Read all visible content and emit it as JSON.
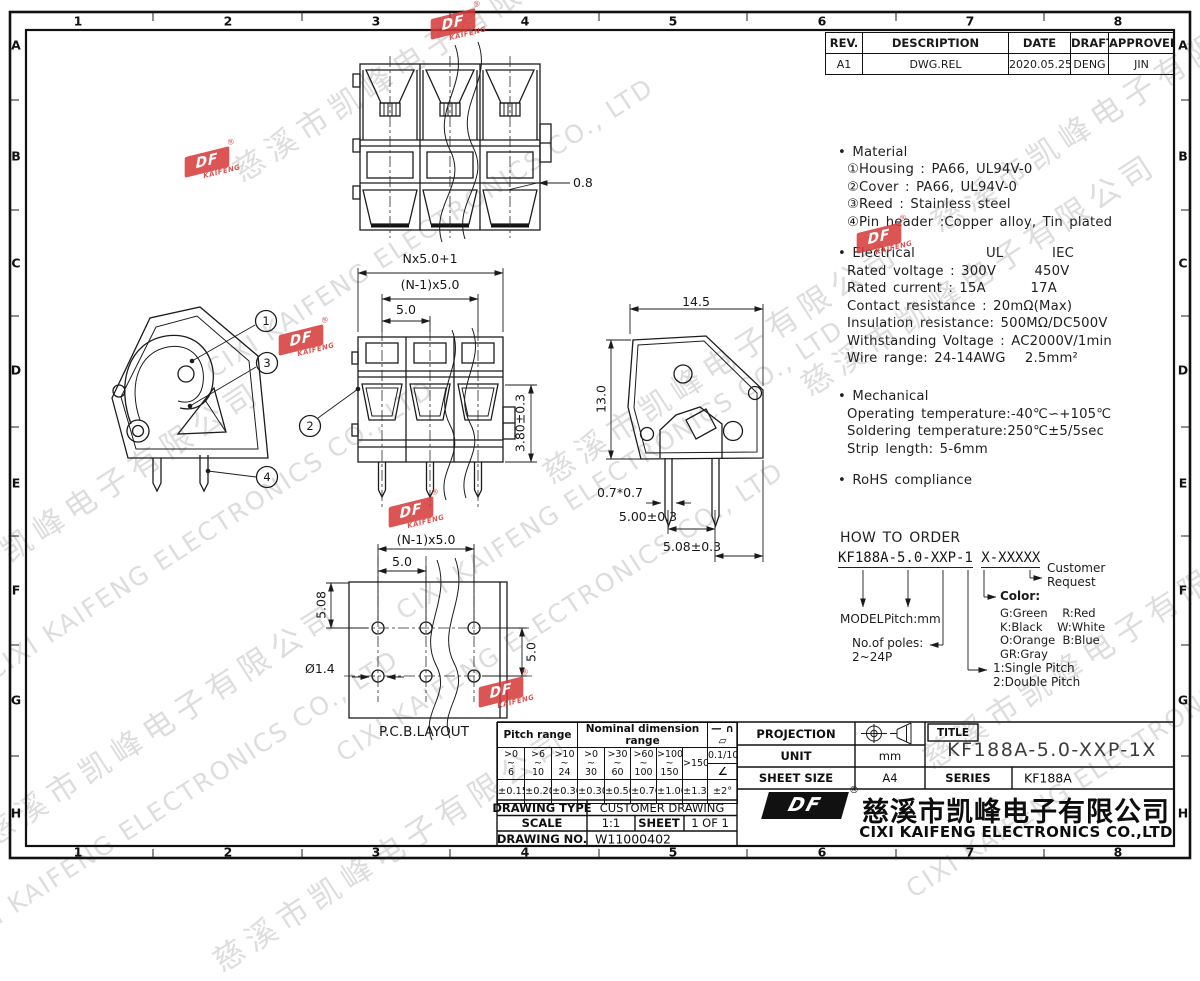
{
  "frame": {
    "cols": [
      "1",
      "2",
      "3",
      "4",
      "5",
      "6",
      "7",
      "8"
    ],
    "rows": [
      "A",
      "B",
      "C",
      "D",
      "E",
      "F",
      "G",
      "H"
    ]
  },
  "revision_table": {
    "headers": [
      "REV.",
      "DESCRIPTION",
      "DATE",
      "DRAFTER",
      "APPROVER"
    ],
    "rows": [
      [
        "A1",
        "DWG.REL",
        "2020.05.25",
        "DENG",
        "JIN"
      ]
    ]
  },
  "specs": {
    "material_title": "• Material",
    "material_lines": [
      "①Housing : PA66, UL94V-0",
      "②Cover : PA66, UL94V-0",
      "③Reed : Stainless steel",
      "④Pin header :Copper alloy, Tin plated"
    ],
    "electrical_title": "• Electrical",
    "electrical_ul": "UL",
    "electrical_iec": "IEC",
    "electrical_lines": [
      "Rated voltage : 300V      450V",
      "Rated current : 15A       17A",
      "Contact resistance : 20mΩ(Max)",
      "Insulation resistance: 500MΩ/DC500V",
      "Withstanding Voltage : AC2000V/1min",
      "Wire range: 24-14AWG   2.5mm²"
    ],
    "mechanical_title": "• Mechanical",
    "mechanical_lines": [
      "Operating temperature:-40℃∽+105℃",
      "Soldering temperature:250℃±5/5sec",
      "Strip length: 5-6mm"
    ],
    "rohs": "• RoHS compliance"
  },
  "order": {
    "title": "HOW TO ORDER",
    "code_left": "KF188A-5.0-XXP-1",
    "code_right": "X-XXXXX",
    "model": "MODEL",
    "pitch": "Pitch:mm",
    "poles": "No.of poles:\n2~24P",
    "pitch_type": "1:Single Pitch\n2:Double Pitch",
    "color_title": "Color:",
    "colors": [
      "G:Green    R:Red",
      "K:Black    W:White",
      "O:Orange  B:Blue",
      "GR:Gray"
    ],
    "customer": "Customer\nRequest"
  },
  "dims": {
    "top_tab": "0.8",
    "overall": "Nx5.0+1",
    "between": "(N-1)x5.0",
    "pitch": "5.0",
    "height_offset": "3.80±0.3",
    "side_width": "14.5",
    "side_height": "13.0",
    "pin_square": "0.7*0.7",
    "pin_spacing": "5.00±0.3",
    "row_spacing": "5.08±0.3",
    "pcb_between": "(N-1)x5.0",
    "pcb_pitch": "5.0",
    "pcb_row": "5.08",
    "pcb_col": "5.0",
    "pcb_hole": "Ø1.4",
    "pcb_label": "P.C.B.LAYOUT"
  },
  "balloons": [
    "1",
    "2",
    "3",
    "4"
  ],
  "tol": {
    "pitch_header": "Pitch range",
    "nominal_header": "Nominal dimension range",
    "symbols": "— ∩ ▱",
    "ranges": [
      ">0\n~\n6",
      ">6\n~\n10",
      ">10\n~\n24",
      ">0\n~\n30",
      ">30\n~\n60",
      ">60\n~\n100",
      ">100\n~\n150",
      ">150"
    ],
    "flat": "0.1/10",
    "angle_sym": "∠",
    "tols": [
      "±0.15",
      "±0.20",
      "±0.30",
      "±0.30",
      "±0.50",
      "±0.70",
      "±1.00",
      "±1.30"
    ],
    "angle_tol": "±2°"
  },
  "tb": {
    "projection": "PROJECTION",
    "unit": "UNIT",
    "unit_v": "mm",
    "sheet_size": "SHEET SIZE",
    "sheet_size_v": "A4",
    "title_label": "TITLE",
    "title_v": "KF188A-5.0-XXP-1X",
    "series": "SERIES",
    "series_v": "KF188A",
    "dtype": "DRAWING TYPE",
    "dtype_v": "CUSTOMER DRAWING",
    "scale": "SCALE",
    "scale_v": "1:1",
    "sheet": "SHEET",
    "sheet_v": "1 OF 1",
    "dno": "DRAWING NO.",
    "dno_v": "W11000402",
    "company_cn": "慈溪市凯峰电子有限公司",
    "company_en": "CIXI KAIFENG ELECTRONICS CO.,LTD",
    "reg": "®"
  },
  "wm": {
    "cn": "慈溪市凯峰电子有限公司",
    "en": "CIXI KAIFENG ELECTRONICS CO., LTD",
    "logo": "DF",
    "logo_sub": "KAIFENG",
    "reg": "®"
  }
}
